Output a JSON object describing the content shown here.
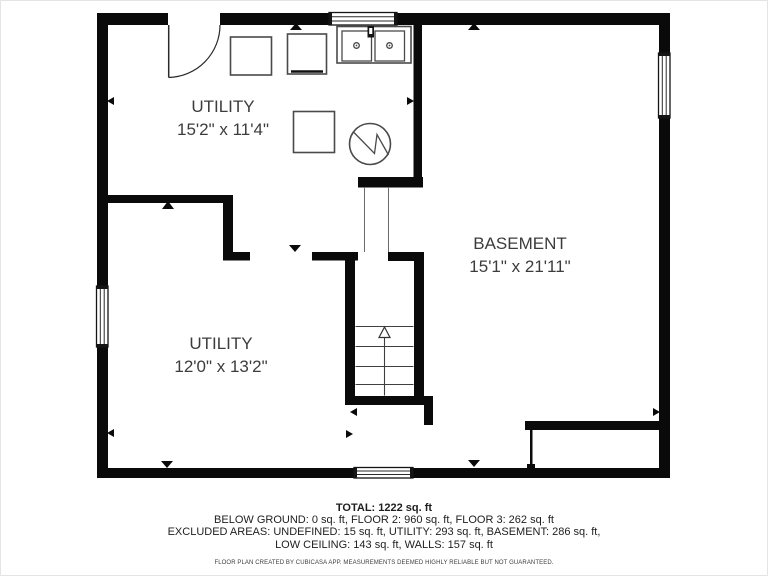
{
  "rooms": [
    {
      "name": "UTILITY",
      "dimensions": "15'2\" x 11'4\""
    },
    {
      "name": "BASEMENT",
      "dimensions": "15'1\" x 21'11\""
    },
    {
      "name": "UTILITY",
      "dimensions": "12'0\" x 13'2\""
    }
  ],
  "footer": {
    "total": "TOTAL: 1222 sq. ft",
    "floors": "BELOW GROUND: 0 sq. ft, FLOOR 2: 960 sq. ft, FLOOR 3: 262 sq. ft",
    "excluded_1": "EXCLUDED AREAS: UNDEFINED: 15 sq. ft, UTILITY: 293 sq. ft, BASEMENT: 286 sq. ft,",
    "excluded_2": "LOW CEILING: 143 sq. ft, WALLS: 157 sq. ft",
    "disclaimer": "FLOOR PLAN CREATED BY CUBICASA APP. MEASUREMENTS DEEMED HIGHLY RELIABLE BUT NOT GUARANTEED."
  },
  "fixtures": {
    "door": "door-swing-icon",
    "sink": "double-sink-icon",
    "water_heater": "water-heater-icon",
    "stairs": "stairs-up-icon",
    "window": "window-icon",
    "appliance": "appliance-square-icon"
  },
  "colors": {
    "wall": "#0a0a0a",
    "furniture_outline": "#4a4a4a",
    "room_text": "#3c3c3c",
    "footer_text": "#1e1e1e",
    "background": "#ffffff"
  }
}
